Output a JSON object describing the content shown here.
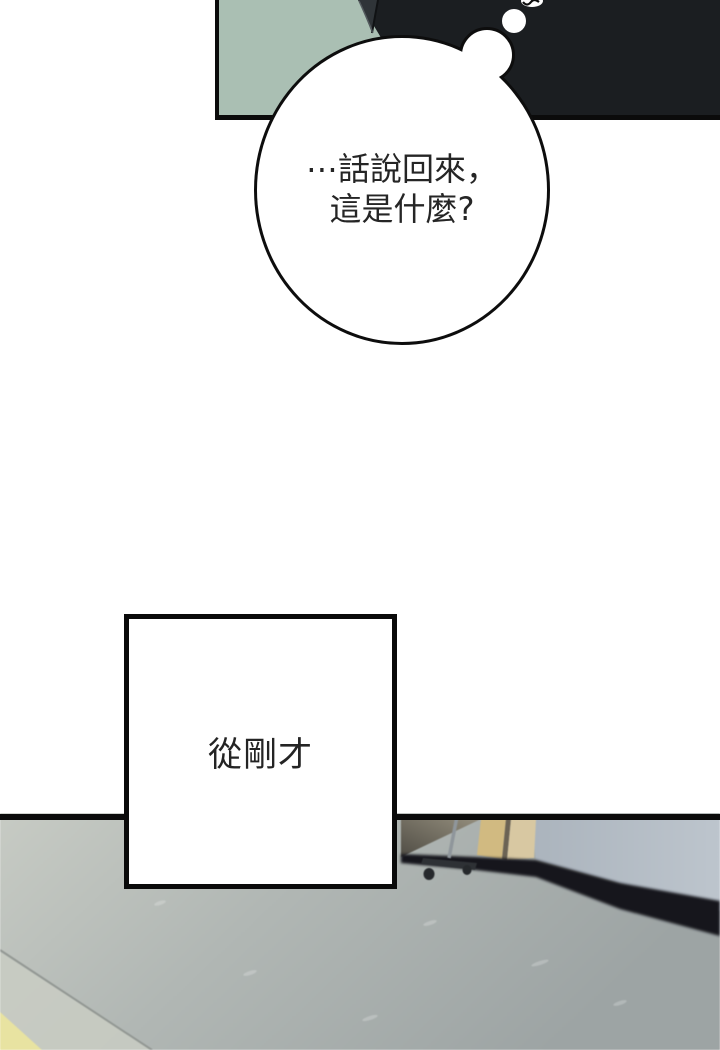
{
  "comic": {
    "bubble": {
      "line1": "⋯話說回來，",
      "line2": "這是什麼?"
    },
    "caption": {
      "text": "從剛才"
    },
    "colors": {
      "panel_bg_green": "#aabfb3",
      "figure_dark": "#1b1e21",
      "figure_edge_gray": "#2f3438",
      "border_black": "#0b0b0b",
      "bubble_fill": "#ffffff",
      "bubble_outline": "#0d0d0d",
      "text_color": "#252525",
      "floor_light": "#c7cbc4",
      "floor_dark": "#9da4a4",
      "wall_left": "#abb4bd",
      "wall_right": "#bdc5cd",
      "baseboard_dark": "#17191c",
      "door_frame_tan": "#d1ba81",
      "door_panel_beige": "#d8c8a2",
      "door_wedge_dark": "#57544b",
      "door_divider": "#6b6354",
      "cart_metal": "#8f969b",
      "cart_base_dark": "#2e3135",
      "wheel_dark": "#26292c",
      "floor_mat_yellow": "#e8e3a1",
      "floor_band_light": "#c9ccc3",
      "seam_gray": "#8a8f8b"
    }
  }
}
